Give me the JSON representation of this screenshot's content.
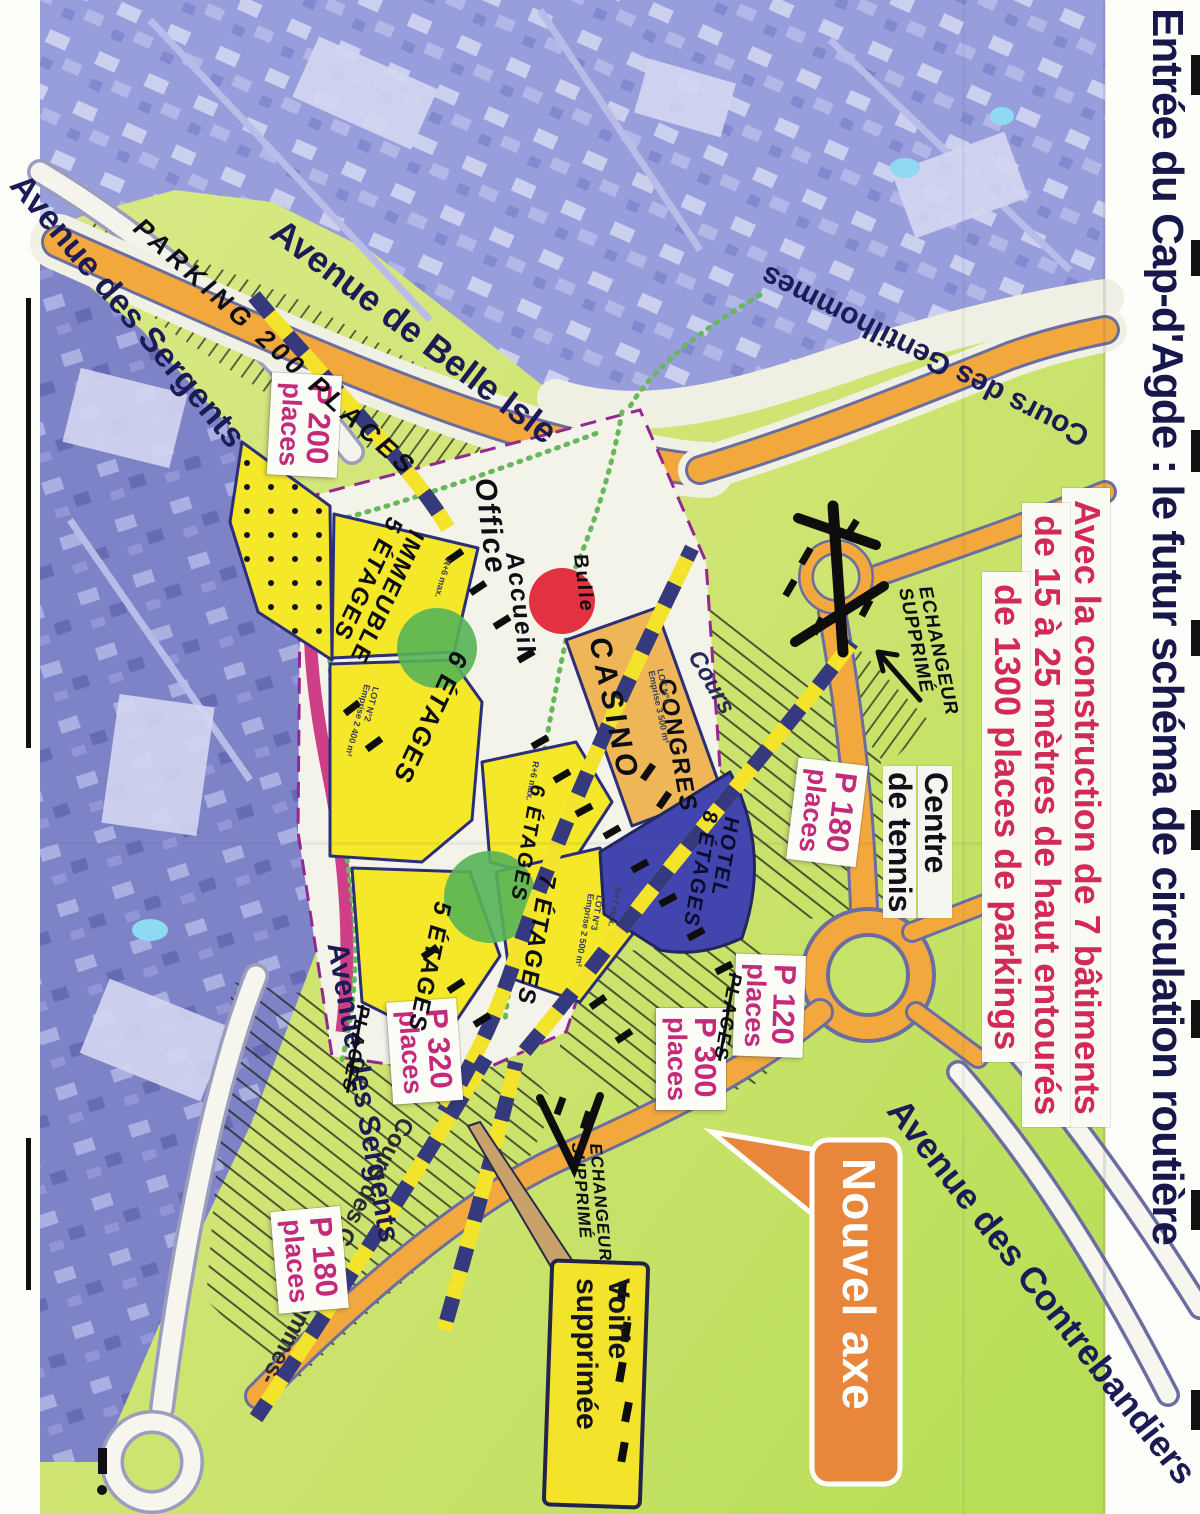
{
  "title": "Entrée du Cap-d'Agde : le futur schéma de circulation routière",
  "banner": {
    "line1": "Avec la construction de 7 bâtiments",
    "line2": "de 15 à 25 mètres de haut entourés",
    "line3": "de 1300 places de parkings"
  },
  "streets": {
    "belle_isle": "Avenue de Belle Isle",
    "sergents_top": "Avenue des Sergents",
    "sergents_bottom": "Avenue des Sergents",
    "gentilhommes_top": "Cours des Gentilhommes",
    "gentilhommes_bottom": "Cours des Gentilhommes-",
    "contrebandiers": "Avenue des Contrebandiers"
  },
  "tennis": {
    "line1": "Centre",
    "line2": "de tennis"
  },
  "parkings": [
    {
      "name": "P 200",
      "sub": "places"
    },
    {
      "name": "P 180",
      "sub": "places"
    },
    {
      "name": "P 120",
      "sub": "places"
    },
    {
      "name": "P 300",
      "sub": "places"
    },
    {
      "name": "P 320",
      "sub": "places"
    },
    {
      "name": "P 180",
      "sub": "places"
    }
  ],
  "handwritten": {
    "parking200": "PARKING 200 PLACES",
    "office": "Office",
    "accueil": "Accueil",
    "bulle": "Bulle",
    "casino": "CASINO",
    "congres": "CONGRES",
    "cours": "Cours",
    "immeuble1": "IMMEUBLE",
    "immeuble2": "5 ÉTAGES",
    "etages6a": "6 ÉTAGES",
    "etages6b": "6 ÉTAGES",
    "etages7": "7 ÉTAGES",
    "etages5": "5 ÉTAGES",
    "hotel1": "HOTEL",
    "hotel2": "8 ÉTAGES",
    "echangeur1a": "ECHANGEUR",
    "echangeur1b": "SUPPRIMÉ",
    "echangeur2a": "ECHANGEUR",
    "echangeur2b": "SUPPRIMÉ",
    "places_crossed_a": "PLACES",
    "places_crossed_b": "PLACES"
  },
  "small_print": {
    "lot1": "LOT N°1",
    "lot1b": "Emprise 3 500 m²",
    "lot2": "LOT N°2",
    "lot2b": "Emprise 2 400 m²",
    "lot3": "LOT N°3",
    "lot3b": "Emprise 2 500 m²",
    "r6a": "R+6 max.",
    "r6b": "R+6 max.",
    "r7": "R+7 max."
  },
  "callouts": {
    "nouvel_axe": "Nouvel axe",
    "voirie1": "Voirie",
    "voirie2": "supprimée"
  },
  "colors": {
    "road_orange": "#f2a83c",
    "plan_green": "#cfe472",
    "photo_blue": "#8e93d6",
    "parcel_yellow": "#f4e829",
    "hotel_blue": "#4345af",
    "casino_orange": "#eeb657",
    "label_magenta": "#c42a7a",
    "banner_red": "#d22a55",
    "title_navy": "#17174b",
    "callout_orange": "#e8873c"
  }
}
